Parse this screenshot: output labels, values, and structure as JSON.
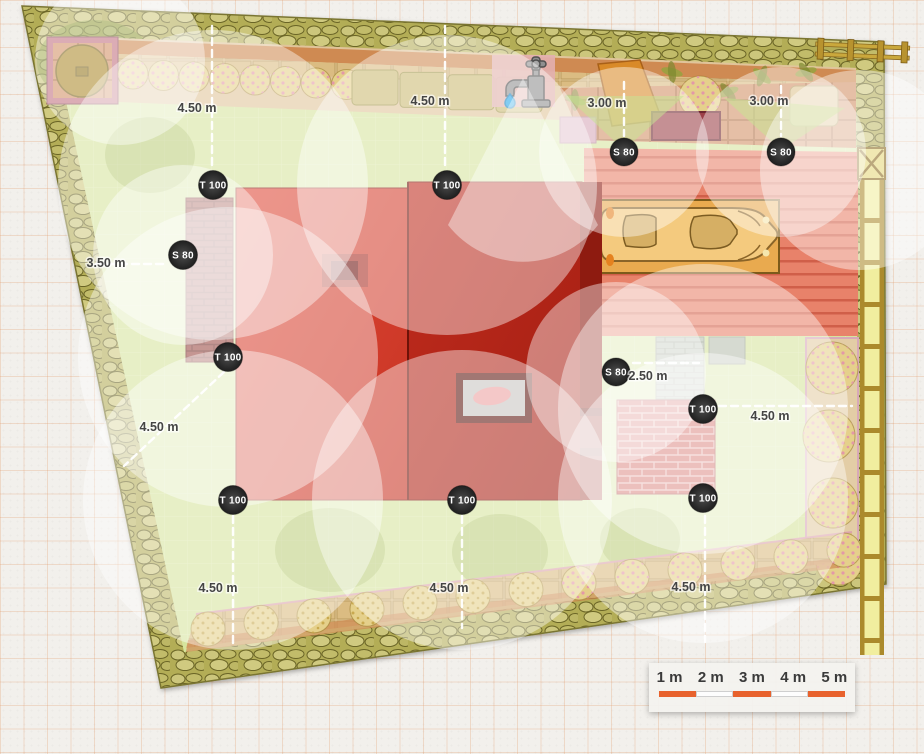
{
  "plan": {
    "title": "garden-irrigation-plan",
    "sprinklers": [
      {
        "label": "S 80"
      },
      {
        "label": "S 80"
      },
      {
        "label": "T 100"
      },
      {
        "label": "T 100"
      },
      {
        "label": "S 80"
      },
      {
        "label": "T 100"
      },
      {
        "label": "S 80"
      },
      {
        "label": "T 100"
      },
      {
        "label": "T 100"
      },
      {
        "label": "T 100"
      },
      {
        "label": "T 100"
      }
    ],
    "measurements": [
      "4.50 m",
      "4.50 m",
      "3.00 m",
      "3.00 m",
      "3.50 m",
      "4.50 m",
      "2.50 m",
      "4.50 m",
      "4.50 m",
      "4.50 m",
      "4.50 m"
    ],
    "icons": {
      "tap": "water-tap",
      "drop": "water-drop"
    }
  },
  "scale_bar": {
    "labels": [
      "1 m",
      "2 m",
      "3 m",
      "4 m",
      "5 m"
    ]
  },
  "colors": {
    "accent_orange": "#e8622d",
    "lawn": "#d6e49d",
    "stone_border": "#b3ad57",
    "building_left": "#d64434",
    "building_right": "#b7271b",
    "terrace": "#e8826a",
    "car_body": "#f4ca7e",
    "coverage": "rgba(255,255,255,0.45)",
    "badge": "#2e2e2e",
    "water_drop": "#29a8e9"
  }
}
